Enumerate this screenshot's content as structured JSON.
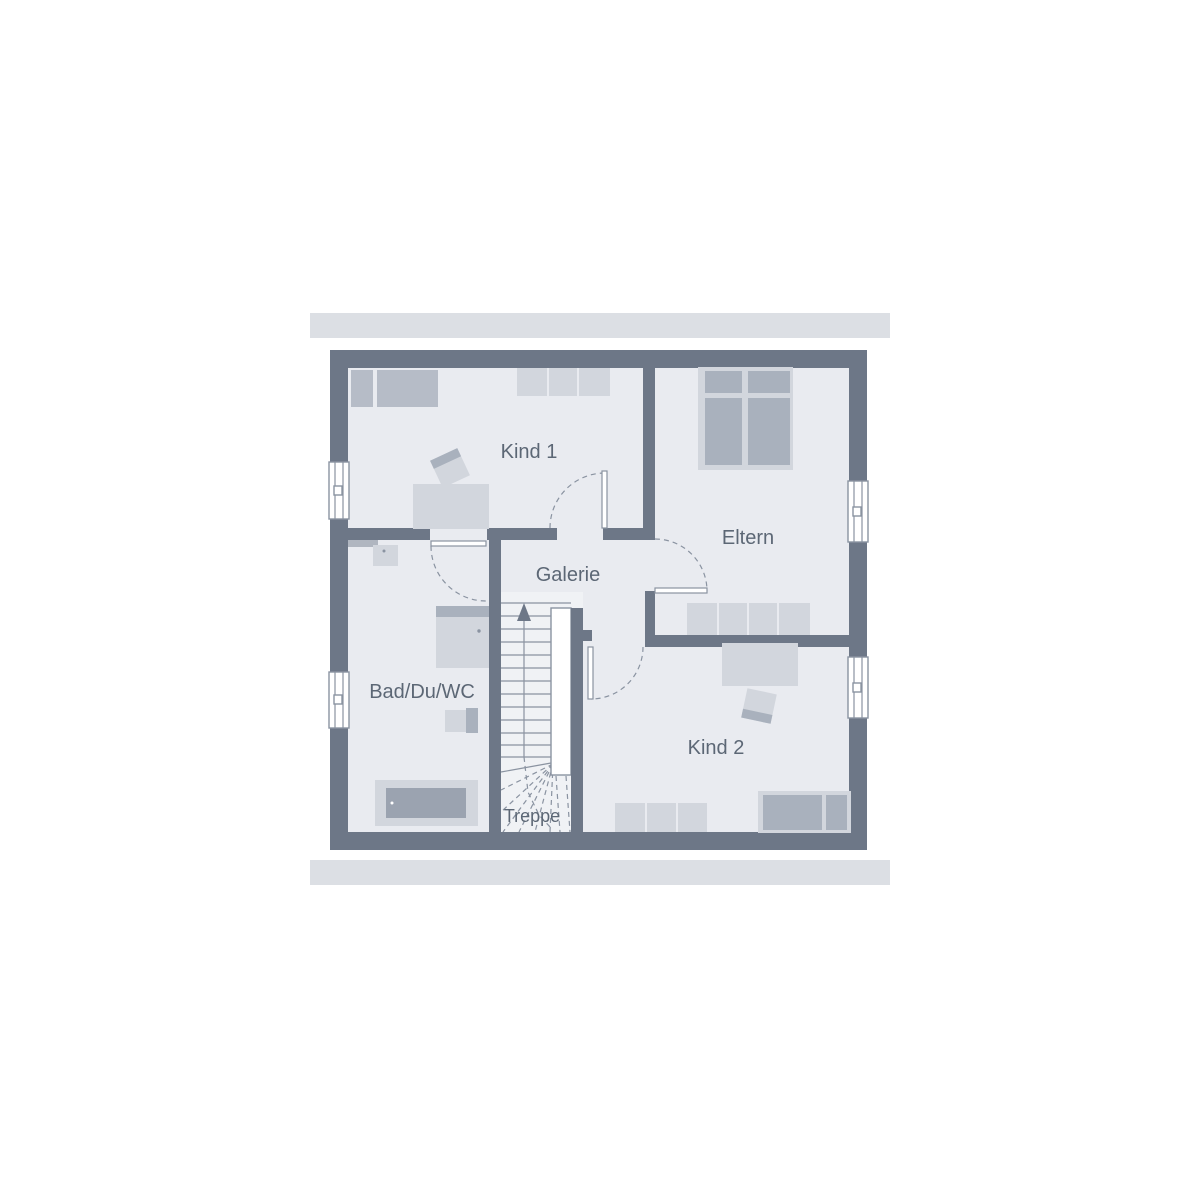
{
  "plan_type": "floor-plan",
  "rooms": {
    "kind1": {
      "label": "Kind 1"
    },
    "eltern": {
      "label": "Eltern"
    },
    "galerie": {
      "label": "Galerie"
    },
    "bad": {
      "label": "Bad/Du/WC"
    },
    "kind2": {
      "label": "Kind 2"
    },
    "treppe": {
      "label": "Treppe"
    }
  },
  "colors": {
    "band": "#dcdfe4",
    "wall": "#6d7787",
    "wall_light": "#b0b6c0",
    "floor": "#e9ebf0",
    "stair_floor": "#f0f2f5",
    "furniture_light": "#d2d6dd",
    "furniture_mid": "#b6bcc7",
    "furniture_dark": "#a9b1bd",
    "tub": "#9ba3b0",
    "line": "#8a93a1",
    "window": "#ffffff",
    "text": "#5c6775"
  }
}
